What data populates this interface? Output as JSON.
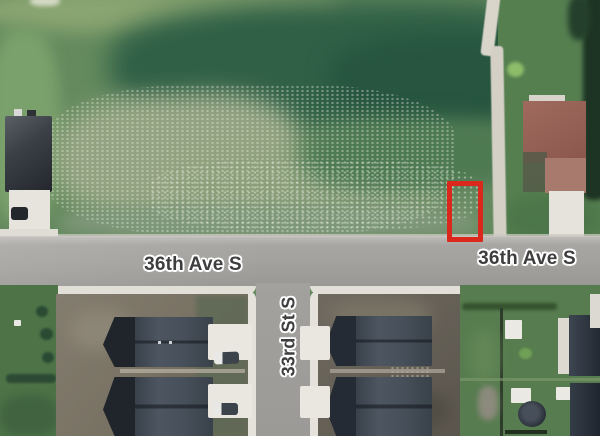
{
  "map": {
    "kind": "aerial-satellite-view",
    "labels": {
      "ave_left": "36th Ave S",
      "ave_right": "36th Ave S",
      "street": "33rd St S"
    },
    "highlight": {
      "name": "selected-parcel-marker",
      "shape": "rectangle",
      "color": "#da291c"
    },
    "colors": {
      "field_green": "#648a5e",
      "dark_field_green": "#2c5a41",
      "pale_grass": "#93a381",
      "road_gray": "#a3a19e",
      "sidewalk_white": "#e2dfd8",
      "label_text": "#3e3e3e",
      "label_halo": "#ffffff",
      "roof_dark_slate": "#39414b",
      "roof_red_brown": "#96655a",
      "driveway_white": "#e9e7e0",
      "dirt_lot": "#6e6859",
      "lawn_green": "#4d7347",
      "tree_dark": "#1d3323"
    }
  }
}
